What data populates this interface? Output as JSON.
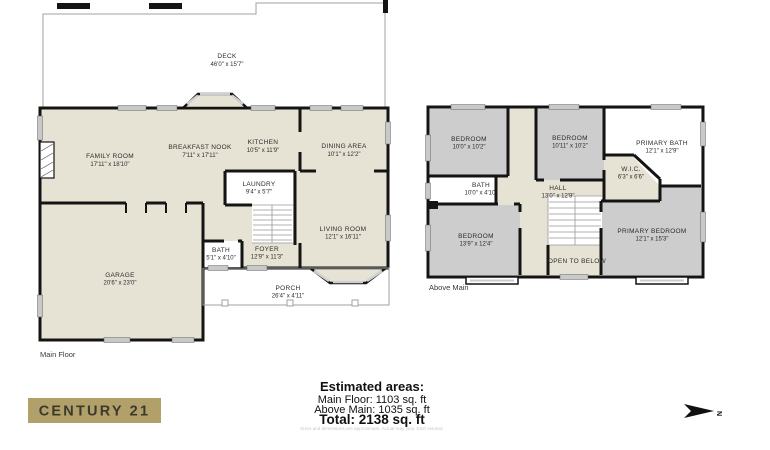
{
  "main_floor": {
    "floor_label": "Main Floor",
    "rooms": [
      {
        "name": "DECK",
        "dims": "46'0\" x 15'7\""
      },
      {
        "name": "FAMILY ROOM",
        "dims": "17'11\" x 18'10\""
      },
      {
        "name": "BREAKFAST NOOK",
        "dims": "7'11\" x 17'11\""
      },
      {
        "name": "KITCHEN",
        "dims": "10'5\" x 11'9\""
      },
      {
        "name": "DINING AREA",
        "dims": "10'1\" x 12'2\""
      },
      {
        "name": "LAUNDRY",
        "dims": "9'4\" x 5'7\""
      },
      {
        "name": "BATH",
        "dims": "5'1\" x 4'10\""
      },
      {
        "name": "FOYER",
        "dims": "12'9\" x 11'3\""
      },
      {
        "name": "LIVING ROOM",
        "dims": "12'1\" x 16'11\""
      },
      {
        "name": "GARAGE",
        "dims": "20'6\" x 23'0\""
      },
      {
        "name": "PORCH",
        "dims": "26'4\" x 4'11\""
      }
    ]
  },
  "above_main": {
    "floor_label": "Above Main",
    "rooms": [
      {
        "name": "BEDROOM",
        "dims": "10'0\" x 10'2\""
      },
      {
        "name": "BEDROOM",
        "dims": "10'11\" x 10'2\""
      },
      {
        "name": "PRIMARY BATH",
        "dims": "12'1\" x 12'9\""
      },
      {
        "name": "W.I.C.",
        "dims": "6'3\" x 6'6\""
      },
      {
        "name": "BATH",
        "dims": "10'0\" x 4'10\""
      },
      {
        "name": "HALL",
        "dims": "13'0\" x 12'9\""
      },
      {
        "name": "BEDROOM",
        "dims": "13'9\" x 12'4\""
      },
      {
        "name": "PRIMARY BEDROOM",
        "dims": "12'1\" x 15'3\""
      },
      {
        "name": "OPEN TO BELOW",
        "dims": ""
      }
    ]
  },
  "summary": {
    "title": "Estimated areas:",
    "main_floor": "Main Floor: 1103 sq. ft",
    "above_main": "Above Main: 1035 sq. ft",
    "total": "Total: 2138 sq. ft",
    "disclaimer": "Sizes and dimensions are approximate. Actual may vary. E&O insured."
  },
  "branding": {
    "logo_text": "CENTURY 21"
  },
  "compass": {
    "label": "N"
  },
  "colors": {
    "floor_fill": "#e7e3d4",
    "bedroom_fill": "#cdcdcd",
    "wall": "#141414",
    "logo_gold": "#b2a06a",
    "window_gray": "#c9c9c9"
  }
}
